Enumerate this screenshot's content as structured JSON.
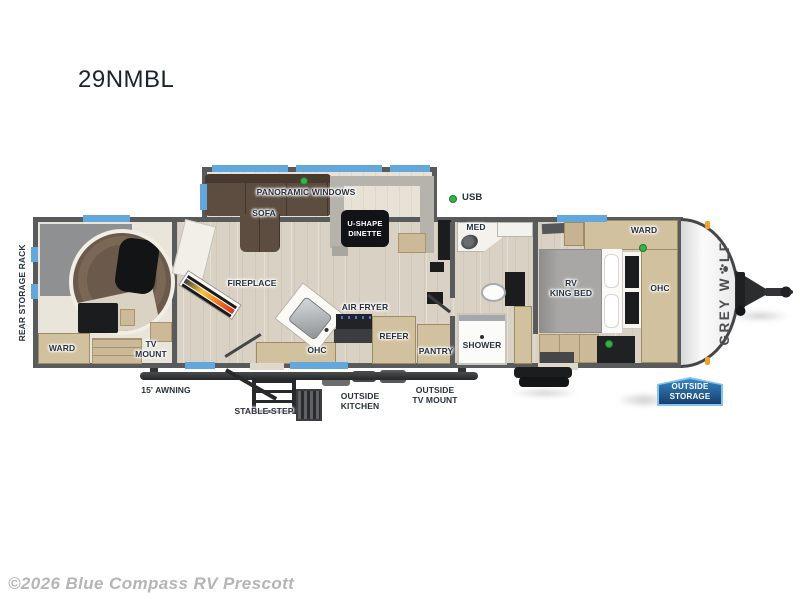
{
  "page": {
    "title": "29NMBL",
    "watermark": "©2026 Blue Compass RV Prescott"
  },
  "legend": {
    "usb": "USB"
  },
  "exterior": {
    "rear_storage_rack": "REAR STORAGE RACK",
    "awning": "15' AWNING",
    "stable_step": "STABLE STEP",
    "outside_kitchen": [
      "OUTSIDE",
      "KITCHEN"
    ],
    "outside_tv_mount": [
      "OUTSIDE",
      "TV MOUNT"
    ],
    "outside_storage": [
      "OUTSIDE",
      "STORAGE"
    ],
    "logo_prefix": "GREY W",
    "logo_suffix": "LF"
  },
  "rear_room": {
    "ward": "WARD",
    "tv_mount": [
      "TV",
      "MOUNT"
    ]
  },
  "living": {
    "panoramic_windows": "PANORAMIC WINDOWS",
    "sofa": "SOFA",
    "dinette": [
      "U-SHAPE",
      "DINETTE"
    ],
    "fireplace": "FIREPLACE"
  },
  "kitchen": {
    "air_fryer": "AIR FRYER",
    "ohc": "OHC",
    "refer": "REFER",
    "pantry": "PANTRY"
  },
  "bath": {
    "med": "MED",
    "shower": "SHOWER"
  },
  "bedroom": {
    "ward": "WARD",
    "bed": [
      "RV",
      "KING BED"
    ],
    "ohc": "OHC"
  },
  "colors": {
    "wall": "#595a5c",
    "window_blue": "#62a8dc",
    "cabinet_tan": "#d2c19e",
    "usb_green": "#35b24a",
    "marker_orange": "#f2a12c",
    "badge_blue_top": "#3585c4",
    "badge_blue_bottom": "#16406f"
  }
}
